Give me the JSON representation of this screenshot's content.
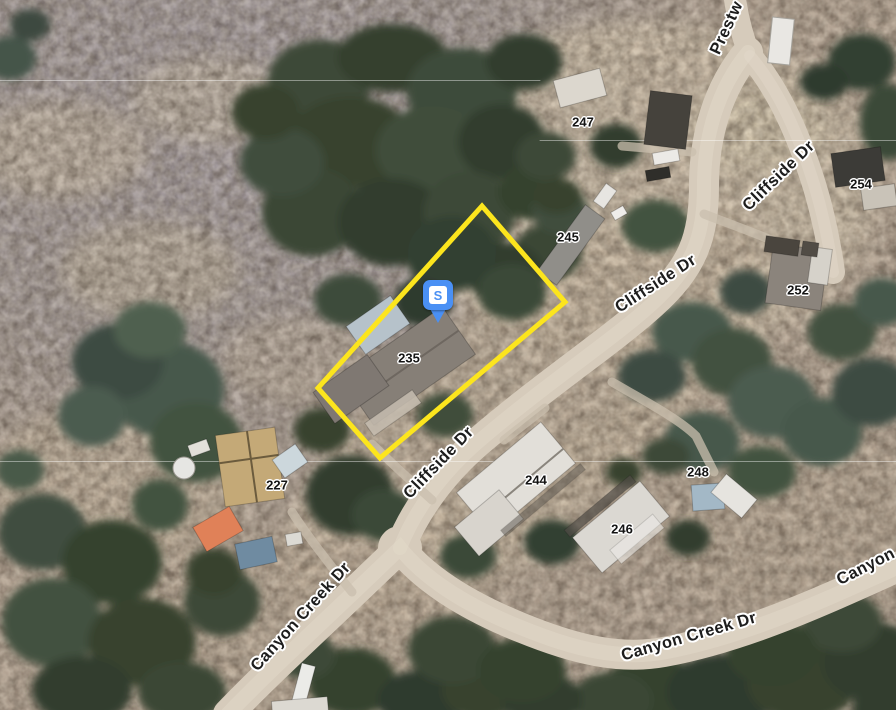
{
  "street_labels": [
    {
      "id": "prestwick-partial",
      "text": "Prestw"
    },
    {
      "id": "cliffside-dr-northeast",
      "text": "Cliffside Dr"
    },
    {
      "id": "cliffside-dr-middle",
      "text": "Cliffside Dr"
    },
    {
      "id": "cliffside-dr-southwest",
      "text": "Cliffside Dr"
    },
    {
      "id": "canyon-creek-dr-west",
      "text": "Canyon Creek Dr"
    },
    {
      "id": "canyon-creek-dr-east",
      "text": "Canyon Creek Dr"
    },
    {
      "id": "canyon-partial",
      "text": "Canyon"
    }
  ],
  "house_numbers": [
    {
      "id": "247",
      "text": "247"
    },
    {
      "id": "245",
      "text": "245"
    },
    {
      "id": "254",
      "text": "254"
    },
    {
      "id": "252",
      "text": "252"
    },
    {
      "id": "235",
      "text": "235"
    },
    {
      "id": "227",
      "text": "227"
    },
    {
      "id": "244",
      "text": "244"
    },
    {
      "id": "246",
      "text": "246"
    },
    {
      "id": "248",
      "text": "248"
    }
  ],
  "marker": {
    "label": "S",
    "pin_color": "#4a90f4",
    "icon_bg": "#ffffff"
  },
  "parcel_highlight": {
    "color": "#fce51d"
  }
}
